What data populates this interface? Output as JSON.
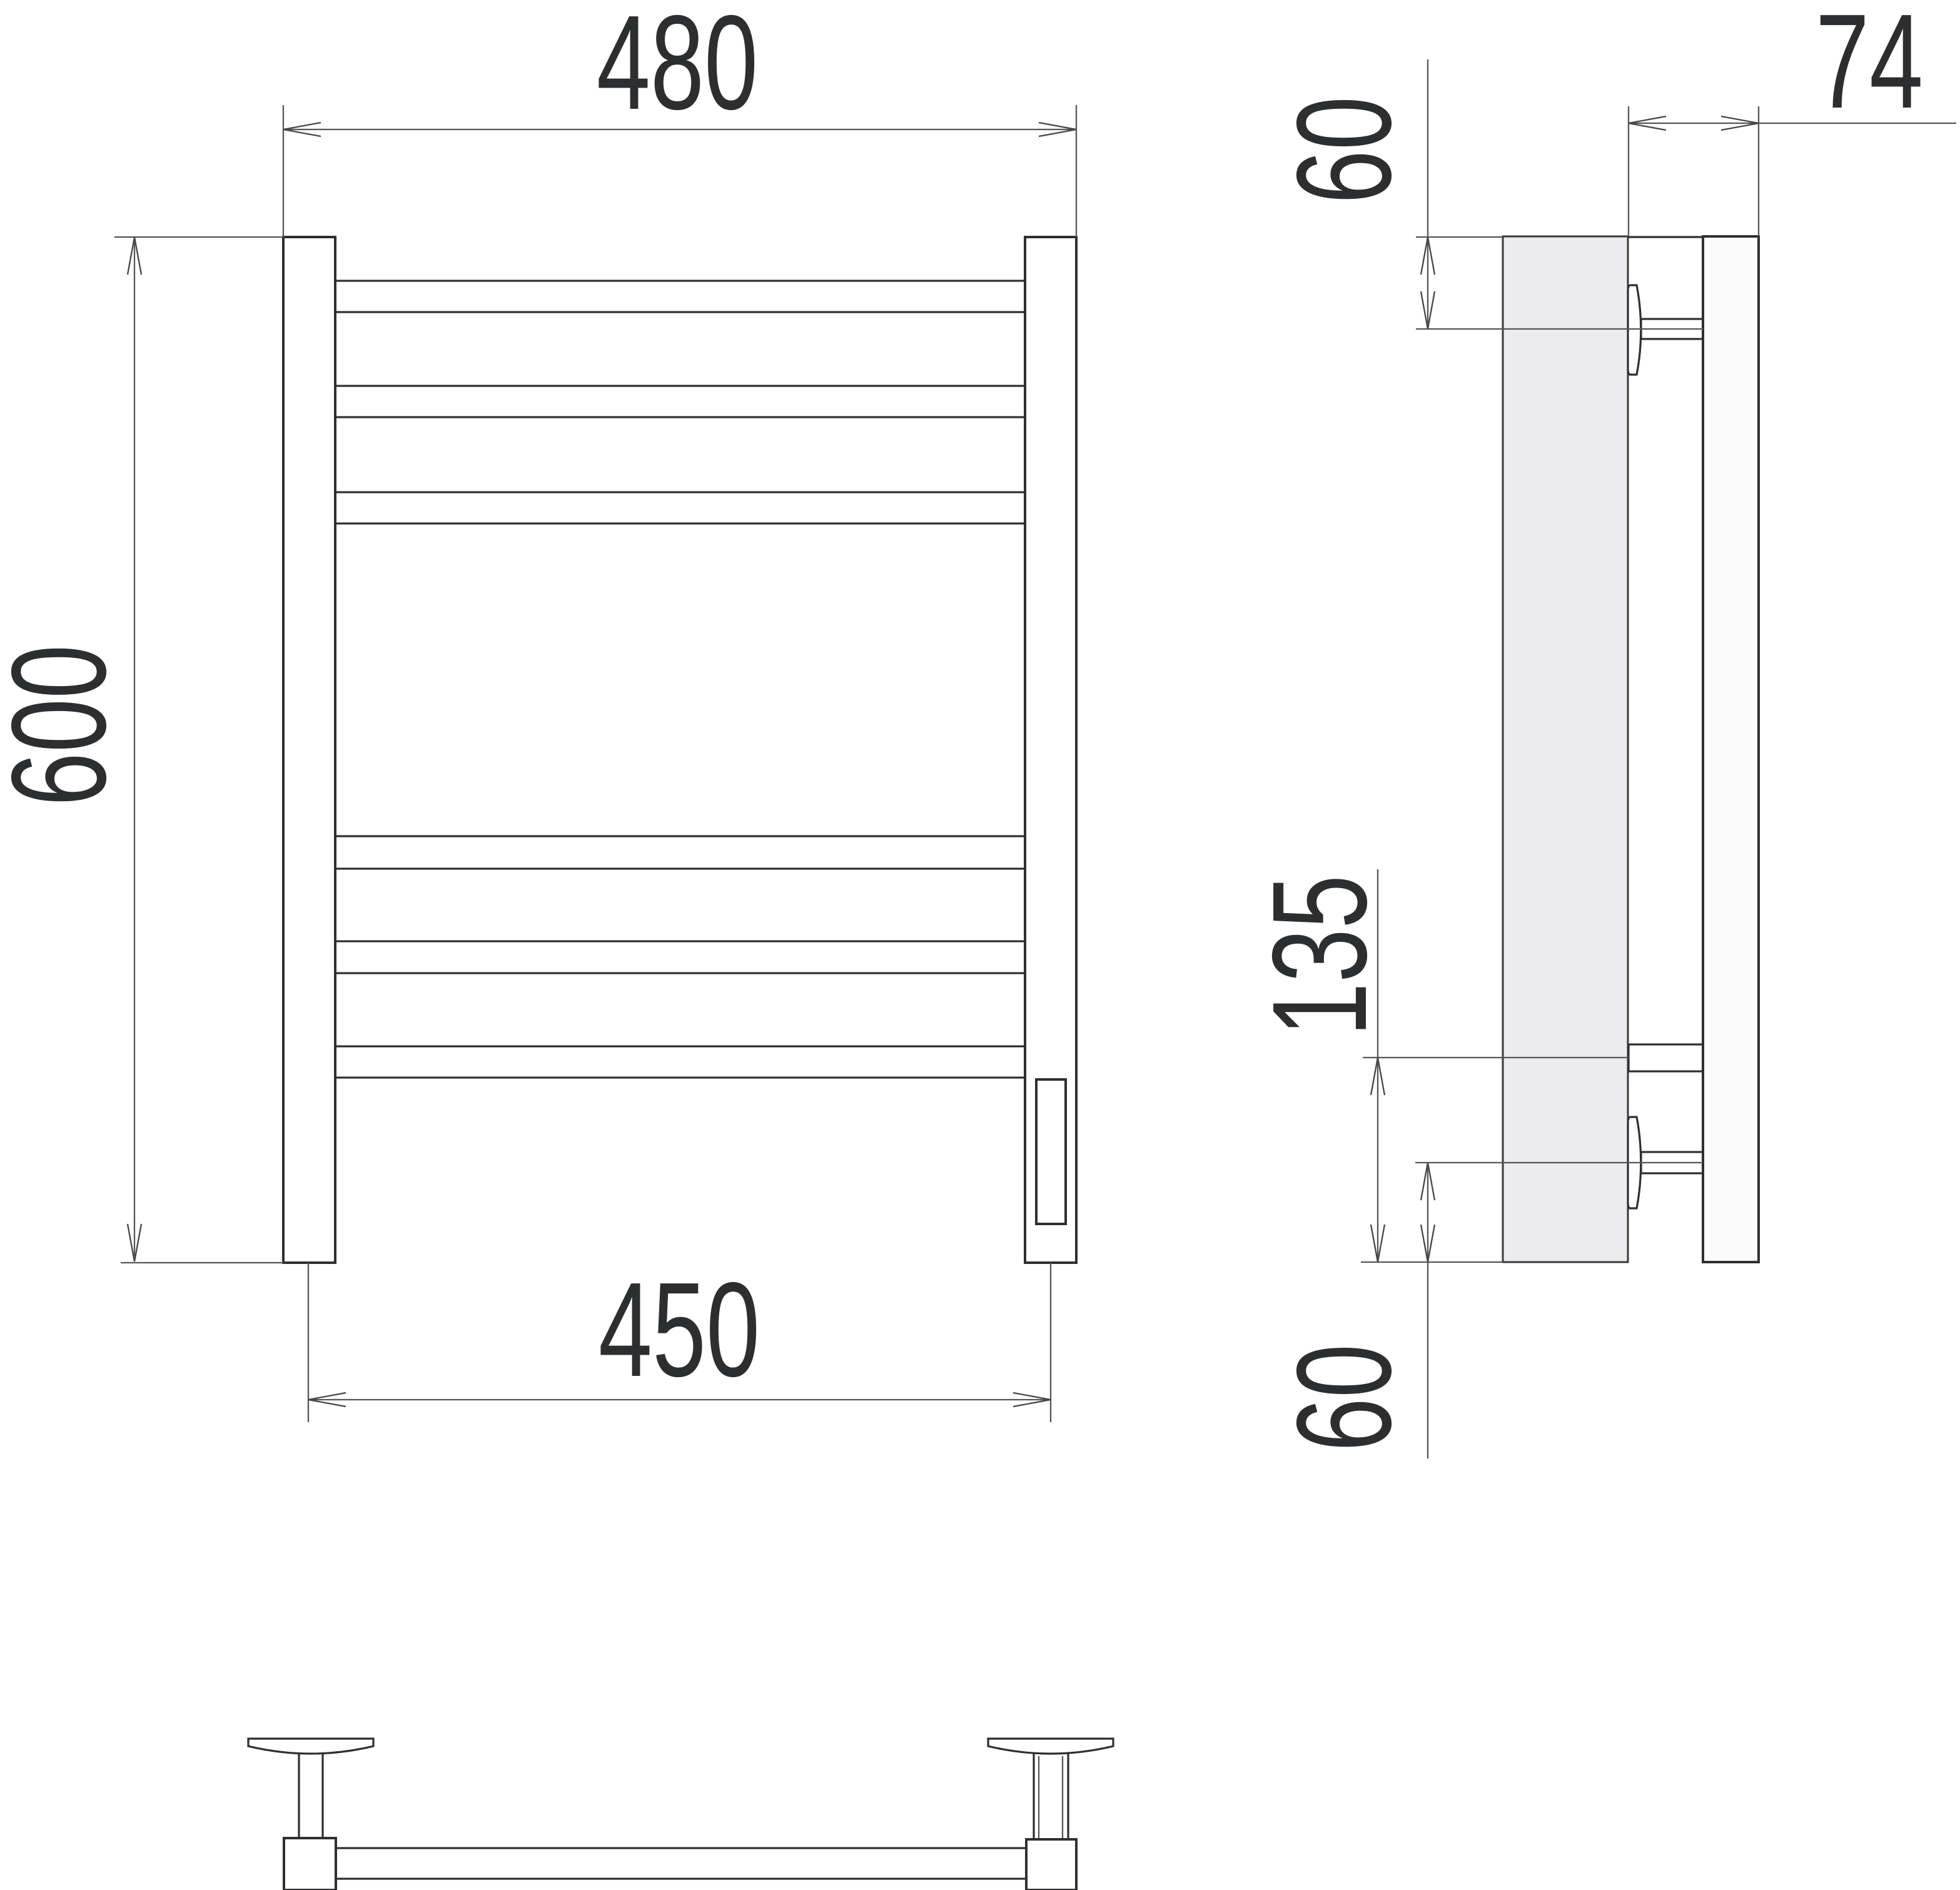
{
  "drawing": {
    "type": "technical-orthographic-drawing",
    "subject": "wall-mounted towel rail / ladder radiator",
    "views": [
      "front",
      "side",
      "bottom"
    ]
  },
  "dimensions": {
    "front_width": "480",
    "front_height": "600",
    "front_span": "450",
    "side_depth": "74",
    "side_top_offset": "60",
    "side_lower_span": "135",
    "side_bottom_offset": "60"
  },
  "colors": {
    "line": "#2f2f31",
    "dim": "#55555a",
    "text": "#2c2e30",
    "wall_fill": "#ececee",
    "background": "#ffffff"
  }
}
